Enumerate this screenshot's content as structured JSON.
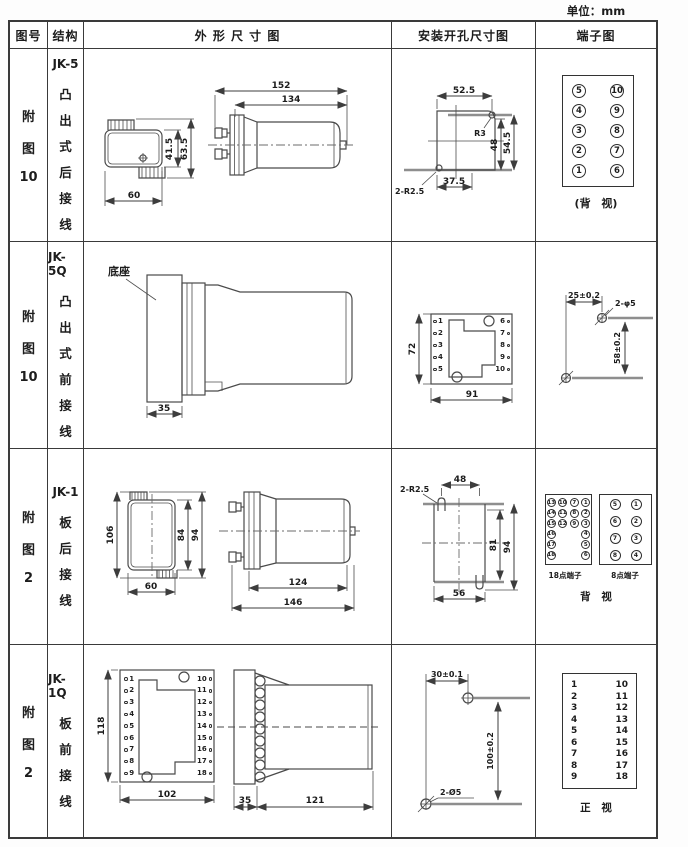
{
  "unit": "单位：mm",
  "columns": [
    "图号",
    "结构",
    "外 形 尺 寸 图",
    "安装开孔尺寸图",
    "端子图"
  ],
  "rows": [
    {
      "fig": [
        "附",
        "图",
        "10"
      ],
      "model": "JK-5",
      "struct": [
        "凸",
        "出",
        "式",
        "后",
        "接",
        "线"
      ],
      "outline": {
        "front_w": "60",
        "front_h1": "41.5",
        "front_h2": "63.5",
        "side_l1": "152",
        "side_l2": "134"
      },
      "mounting": {
        "top": "52.5",
        "corner": "R3",
        "h1": "48",
        "h2": "54.5",
        "bottom": "37.5",
        "holes": "2-R2.5"
      },
      "terminal": {
        "pins": [
          "5",
          "10",
          "4",
          "9",
          "3",
          "8",
          "2",
          "7",
          "1",
          "6"
        ],
        "caption": "(背 视)"
      }
    },
    {
      "fig": [
        "附",
        "图",
        "10"
      ],
      "model": "JK-5Q",
      "struct": [
        "凸",
        "出",
        "式",
        "前",
        "接",
        "线"
      ],
      "outline": {
        "base_label": "底座",
        "base_w": "35"
      },
      "mounting": {
        "h": "72",
        "w": "91",
        "left_pins": [
          "1",
          "2",
          "3",
          "4",
          "5"
        ],
        "right_pins": [
          "6",
          "7",
          "8",
          "9",
          "10"
        ]
      },
      "terminal": {
        "dim_h": "25±0.2",
        "holes": "2-φ5",
        "dim_v": "58±0.2"
      }
    },
    {
      "fig": [
        "附",
        "图",
        "2"
      ],
      "model": "JK-1",
      "struct": [
        "板",
        "后",
        "接",
        "线"
      ],
      "outline": {
        "front_h": "106",
        "front_h1": "84",
        "front_h2": "94",
        "front_w": "60",
        "side_l1": "124",
        "side_l2": "146"
      },
      "mounting": {
        "holes": "2-R2.5",
        "top": "48",
        "h1": "81",
        "h2": "94",
        "bottom": "56"
      },
      "terminal": {
        "grid18": [
          "13",
          "10",
          "7",
          "1",
          "14",
          "11",
          "8",
          "2",
          "15",
          "12",
          "9",
          "3",
          "16",
          "",
          "",
          "4",
          "17",
          "",
          "",
          "5",
          "18",
          "",
          "",
          "6"
        ],
        "label18": "18点端子",
        "grid8": [
          "5",
          "1",
          "6",
          "2",
          "7",
          "3",
          "8",
          "4"
        ],
        "label8": "8点端子",
        "caption": "背 视"
      }
    },
    {
      "fig": [
        "附",
        "图",
        "2"
      ],
      "model": "JK-1Q",
      "struct": [
        "板",
        "前",
        "接",
        "线"
      ],
      "outline": {
        "front_h": "118",
        "front_w": "102",
        "left_pins": [
          "1",
          "2",
          "3",
          "4",
          "5",
          "6",
          "7",
          "8",
          "9"
        ],
        "right_pins": [
          "10",
          "11",
          "12",
          "13",
          "14",
          "15",
          "16",
          "17",
          "18"
        ],
        "side_w1": "35",
        "side_w2": "121"
      },
      "mounting": {
        "dim_h": "30±0.1",
        "dim_v": "100±0.2",
        "holes": "2-Ø5"
      },
      "terminal": {
        "left": [
          "1",
          "2",
          "3",
          "4",
          "5",
          "6",
          "7",
          "8",
          "9"
        ],
        "right": [
          "10",
          "11",
          "12",
          "13",
          "14",
          "15",
          "16",
          "17",
          "18"
        ],
        "caption": "正 视"
      }
    }
  ]
}
